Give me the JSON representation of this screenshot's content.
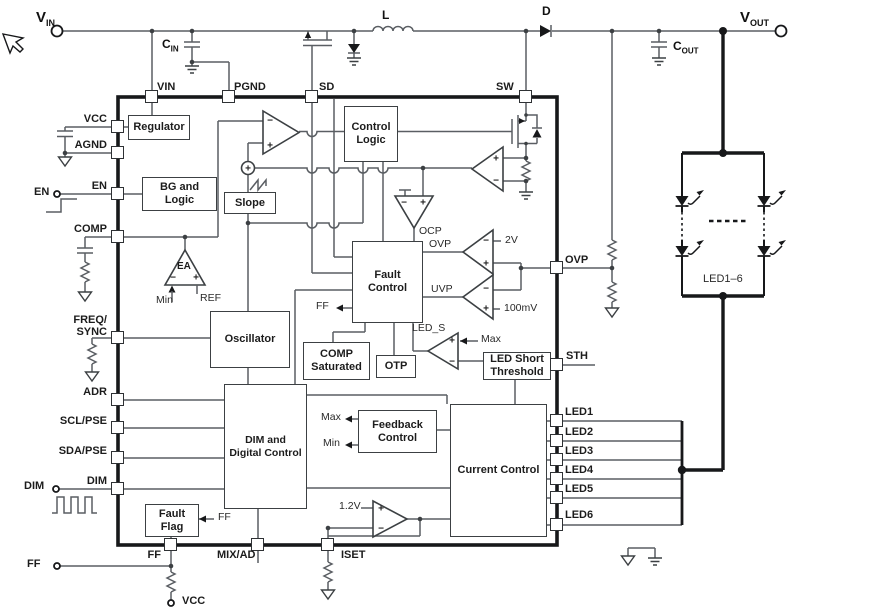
{
  "signs": {
    "plus": "+",
    "minus": "−"
  },
  "terminals": {
    "vin": {
      "name": "V",
      "sub": "IN"
    },
    "vout": {
      "name": "V",
      "sub": "OUT"
    },
    "en": "EN",
    "dim": "DIM",
    "ff": "FF",
    "vcc": "VCC"
  },
  "components": {
    "cin": {
      "name": "C",
      "sub": "IN"
    },
    "cout": {
      "name": "C",
      "sub": "OUT"
    },
    "inductor": "L",
    "diode": "D",
    "led_string": "LED1–6"
  },
  "pins": {
    "top": [
      "VIN",
      "PGND",
      "SD",
      "SW"
    ],
    "left": [
      "VCC",
      "AGND",
      "EN",
      "COMP",
      "FREQ/\nSYNC",
      "ADR",
      "SCL/PSE",
      "SDA/PSE",
      "DIM"
    ],
    "bottom": [
      "FF",
      "MIX/AD",
      "ISET"
    ],
    "right": [
      "OVP",
      "STH",
      "LED1",
      "LED2",
      "LED3",
      "LED4",
      "LED5",
      "LED6"
    ]
  },
  "blocks": {
    "regulator": "Regulator",
    "bg_logic": "BG and\nLogic",
    "slope": "Slope",
    "control_logic": "Control\nLogic",
    "fault_control": "Fault\nControl",
    "oscillator": "Oscillator",
    "comp_saturated": "COMP\nSaturated",
    "otp": "OTP",
    "led_short_threshold": "LED Short\nThreshold",
    "dim_digital": "DIM and\nDigital Control",
    "feedback_control": "Feedback\nControl",
    "current_control": "Current Control",
    "fault_flag": "Fault\nFlag"
  },
  "labels": {
    "ea": "EA",
    "min_ea": "Min",
    "ref": "REF",
    "ocp": "OCP",
    "ovp_comp": "OVP",
    "uvp_comp": "UVP",
    "ovp_ref": "2V",
    "uvp_ref": "100mV",
    "led_s": "LED_S",
    "max_led": "Max",
    "ff_fault": "FF",
    "ff_flag": "FF",
    "max_fb": "Max",
    "min_fb": "Min",
    "iset_ref": "1.2V"
  }
}
